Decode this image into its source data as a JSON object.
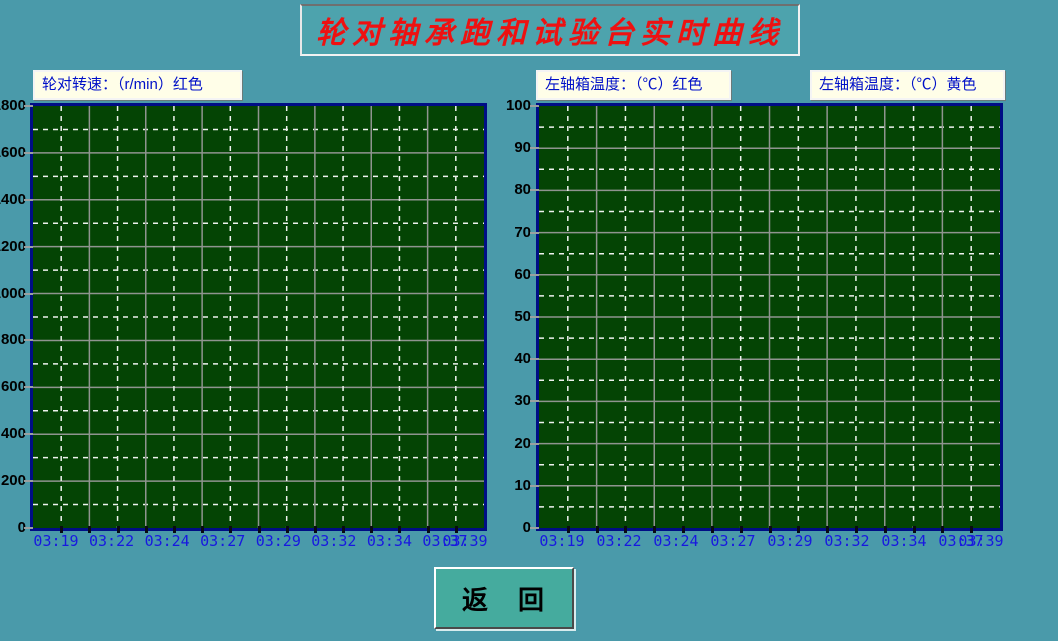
{
  "window": {
    "title": "轮对轴承跑和试验台实时曲线"
  },
  "colors": {
    "page_bg": "#4a9aaa",
    "title_text": "#ee1111",
    "header_box_bg": "#fffee8",
    "header_text": "#0010c8",
    "plot_bg": "#044404",
    "plot_border": "#000d85",
    "grid_solid": "#8f948f",
    "grid_dashed": "#eef2ee",
    "y_tick_label": "#000000",
    "x_tick_label": "#1818e0",
    "button_bg": "#45ab9e",
    "series_red": "#ff0000",
    "series_yellow": "#ffff00"
  },
  "chart_data": [
    {
      "id": "wheelset-speed",
      "type": "line",
      "title": "轮对转速：（r/min）红色",
      "ylabel": "r/min",
      "ylim": [
        0,
        1800
      ],
      "yticks": [
        0,
        200,
        400,
        600,
        800,
        1000,
        1200,
        1400,
        1600,
        1800
      ],
      "x_ticklabels": [
        "03:19",
        "03:22",
        "03:24",
        "03:27",
        "03:29",
        "03:32",
        "03:34",
        "03:37",
        "03:39"
      ],
      "grid": true,
      "legend_position": "top-label",
      "series": [
        {
          "name": "轮对转速",
          "color_name": "红色",
          "color": "#ff0000",
          "values": []
        }
      ]
    },
    {
      "id": "axlebox-temperature",
      "type": "line",
      "titles": [
        "左轴箱温度：（℃）红色",
        "左轴箱温度：（℃）黄色"
      ],
      "ylabel": "℃",
      "ylim": [
        0,
        100
      ],
      "yticks": [
        0,
        10,
        20,
        30,
        40,
        50,
        60,
        70,
        80,
        90,
        100
      ],
      "x_ticklabels": [
        "03:19",
        "03:22",
        "03:24",
        "03:27",
        "03:29",
        "03:32",
        "03:34",
        "03:37",
        "03:39"
      ],
      "grid": true,
      "legend_position": "top-label",
      "series": [
        {
          "name": "左轴箱温度",
          "color_name": "红色",
          "color": "#ff0000",
          "values": []
        },
        {
          "name": "左轴箱温度",
          "color_name": "黄色",
          "color": "#ffff00",
          "values": []
        }
      ]
    }
  ],
  "button": {
    "label": "返　回"
  }
}
